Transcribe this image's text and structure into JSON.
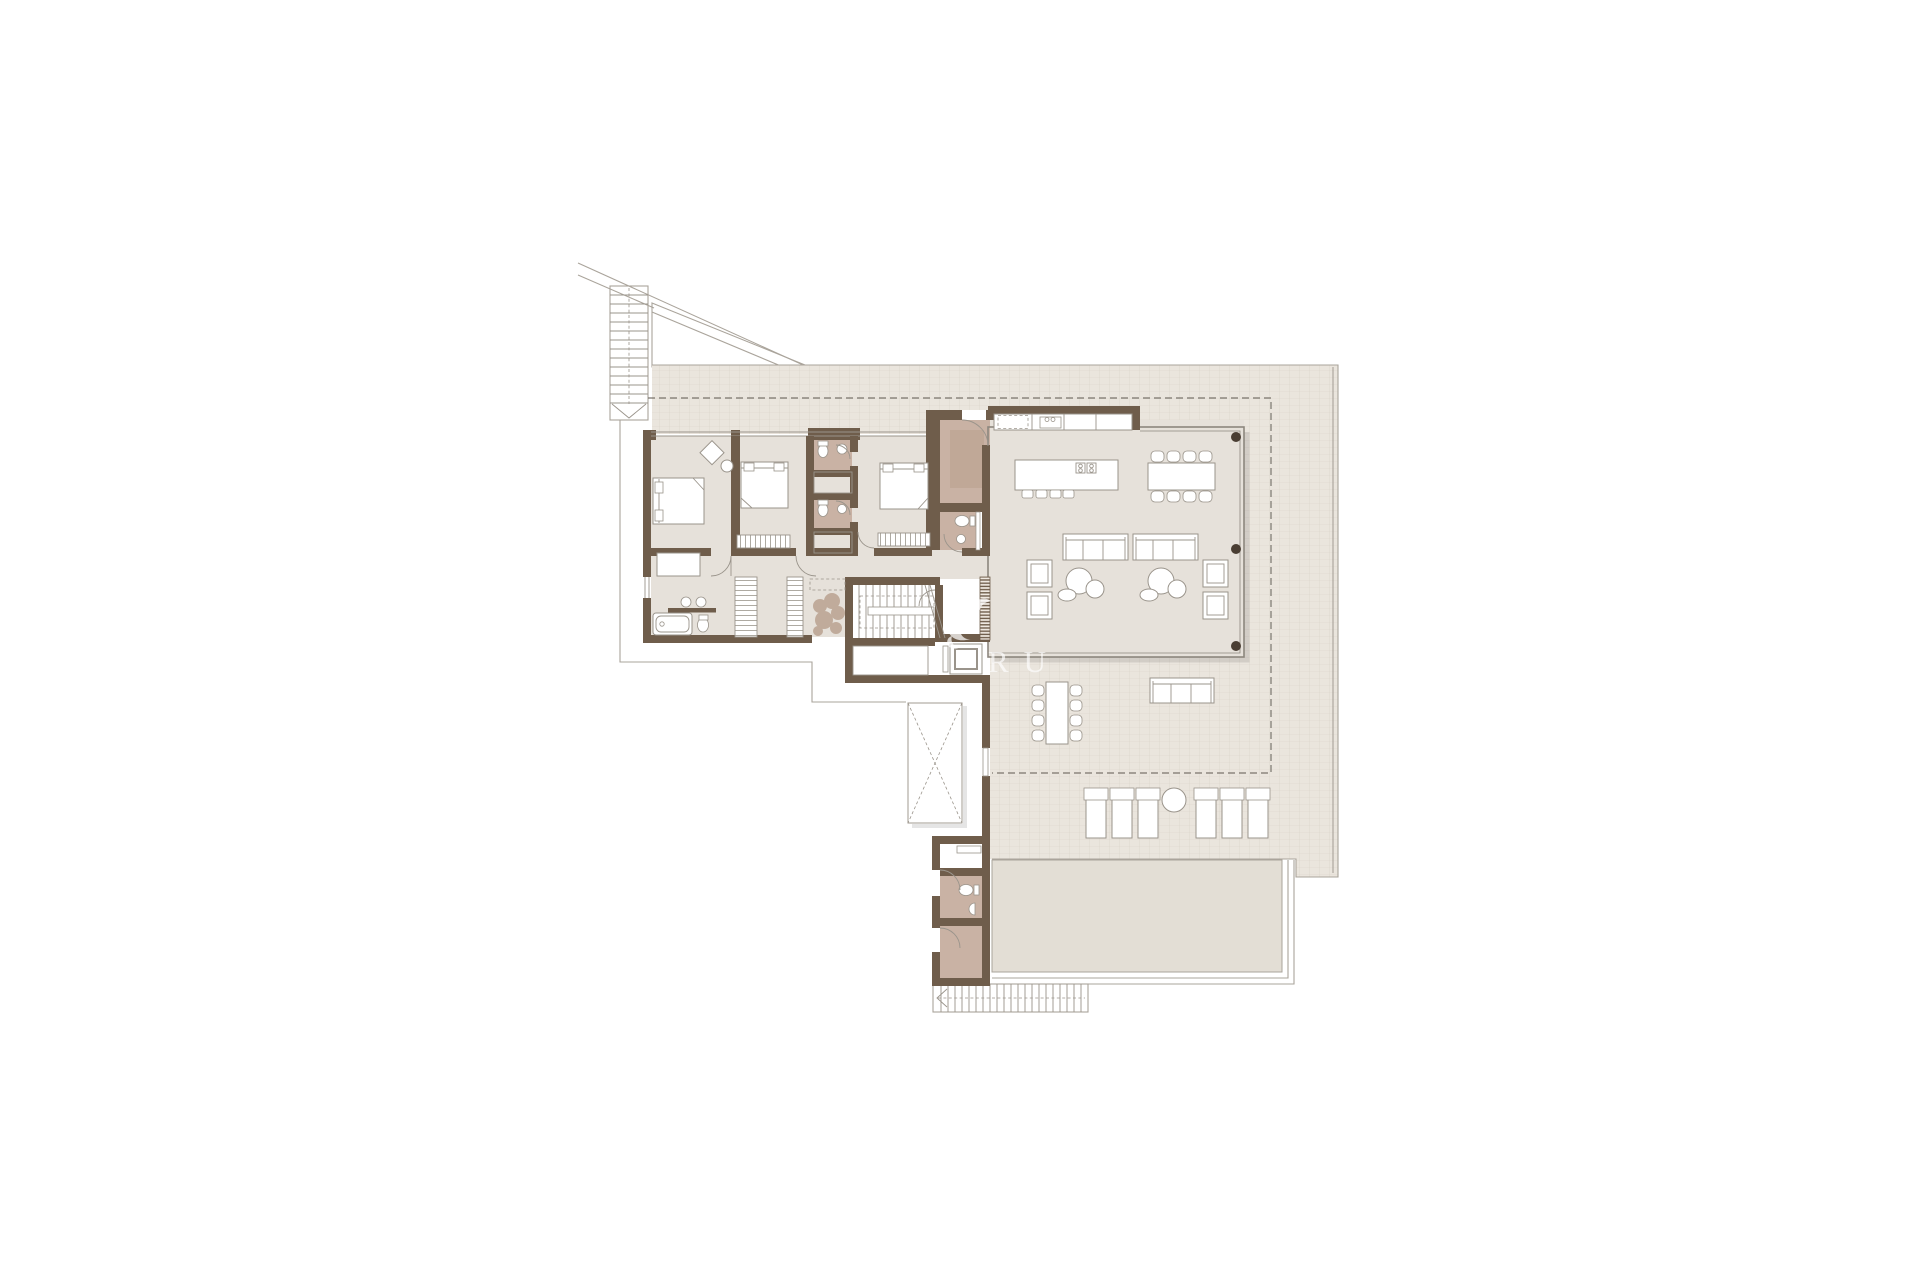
{
  "document": {
    "kind": "architectural-floor-plan",
    "watermark": {
      "letters": "RU"
    }
  },
  "colors": {
    "background": "#ffffff",
    "wall": "#6f5d4b",
    "floor": "#e6e1da",
    "bath_floor": "#c9b2a4",
    "bath_rug": "#c0a897",
    "tile": "#eae5dd",
    "tile_line": "#d8d1c7",
    "pool": "#e3ded5",
    "furniture_fill": "#ffffff",
    "furniture_stroke": "#9a948b",
    "site_line": "#aaa49b",
    "dash": "#7a756d",
    "glass": "#8d877e",
    "column": "#4a3e33",
    "plant": "#b49a86",
    "watermark": "#ffffff"
  }
}
